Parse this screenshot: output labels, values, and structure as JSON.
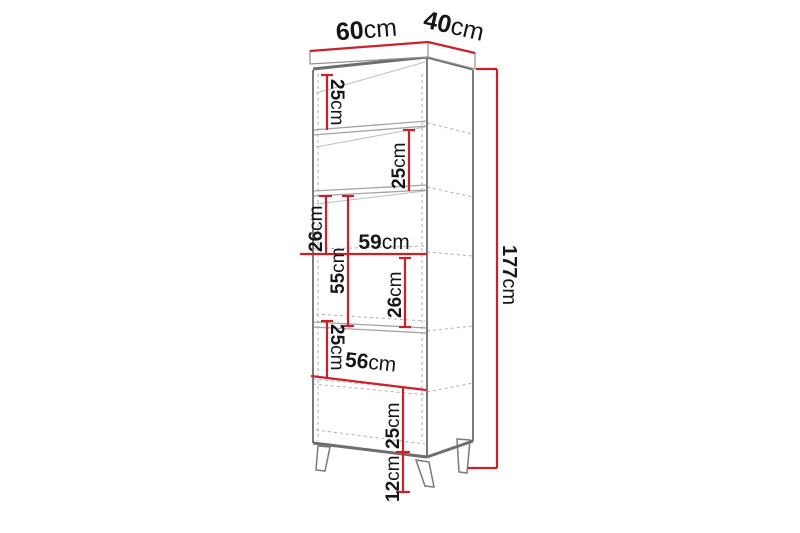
{
  "diagram": {
    "type": "furniture-dimension-drawing",
    "subject": "tall-cabinet-with-legs",
    "colors": {
      "dimension_red": "#cc2128",
      "edge_grey": "#6d6d6d",
      "line_grey": "#a3a3a3",
      "hidden_dash_grey": "#b0b0b0",
      "text_black": "#161616",
      "background": "#ffffff"
    },
    "dims": {
      "top_width": {
        "value": "60",
        "unit": "cm"
      },
      "top_depth": {
        "value": "40",
        "unit": "cm"
      },
      "shelf1_height": {
        "value": "25",
        "unit": "cm"
      },
      "shelf2_height": {
        "value": "25",
        "unit": "cm"
      },
      "mid_upper_height": {
        "value": "26",
        "unit": "cm"
      },
      "door_height": {
        "value": "55",
        "unit": "cm"
      },
      "inner_width_mid": {
        "value": "59",
        "unit": "cm"
      },
      "mid_lower_height": {
        "value": "26",
        "unit": "cm"
      },
      "lower_upper_height": {
        "value": "25",
        "unit": "cm"
      },
      "inner_width_low": {
        "value": "56",
        "unit": "cm"
      },
      "lower_lower_height": {
        "value": "25",
        "unit": "cm"
      },
      "leg_height": {
        "value": "12",
        "unit": "cm"
      },
      "total_height": {
        "value": "177",
        "unit": "cm"
      }
    }
  }
}
